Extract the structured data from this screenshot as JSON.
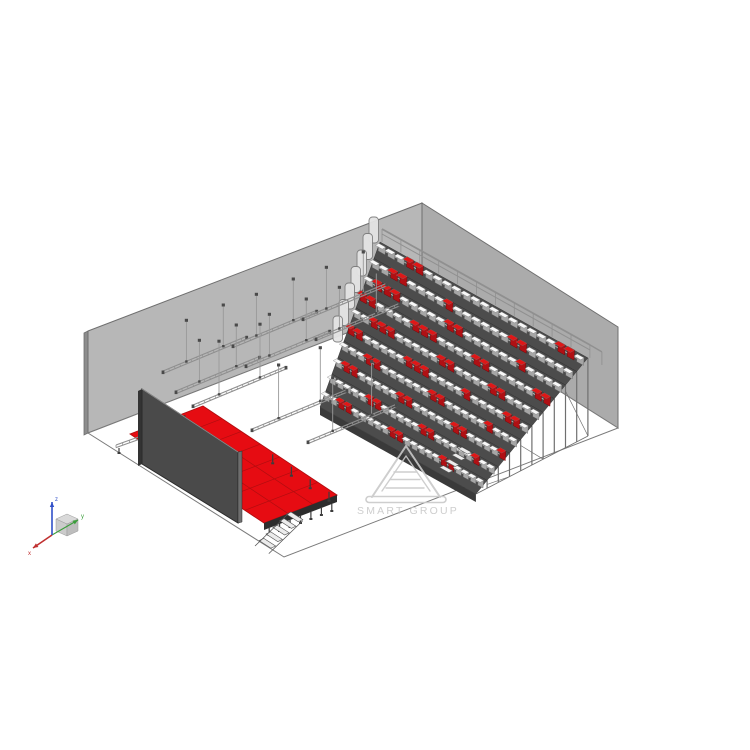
{
  "page": {
    "background": "#ffffff"
  },
  "watermark": {
    "text": "SMART GROUP",
    "color": "#c9c9c9"
  },
  "axis_triad": {
    "labels": {
      "x": "x",
      "y": "y",
      "z": "z"
    },
    "colors": {
      "x": "#c03030",
      "y": "#3a9e3a",
      "z": "#3050c8",
      "cube": "#d9d9d9"
    },
    "origin": [
      52,
      535
    ],
    "x_tip": [
      33,
      548
    ],
    "y_tip": [
      78,
      520
    ],
    "z_tip": [
      52,
      502
    ]
  },
  "scene": {
    "colors": {
      "wall_left": "#b7b7b7",
      "wall_right": "#ababab",
      "wall_edge": "#8d8d8d",
      "wall_outline": "#6f6f6f",
      "floor_fill": "#ffffff",
      "floor_outline": "#7a7a7a",
      "stage_red": "#e60c12",
      "stage_grid": "#b20d10",
      "stage_fascia": "#2d2d2d",
      "leg": "#3c3c3c",
      "screen_face": "#4a4a4a",
      "screen_edge_light": "#6e6e6e",
      "screen_outline": "#2b2b2b",
      "stand_band": "#4c4c4c",
      "stand_band_outline": "#2c2c2c",
      "stand_rail_light": "#b8b8b8",
      "stand_fascia": "#3a3a3a",
      "seat_back_gray": "#a6a6a6",
      "seat_top_white": "#f8f8f8",
      "seat_red_dark": "#b01014",
      "seat_red_bright": "#e01717",
      "railing": "#909090",
      "panel_fill": "#e4e4e4",
      "panel_stroke": "#7c7c7c",
      "truss_line": "#8f8f8f",
      "truss_conn": "#4a4a4a",
      "post": "#6f6f6f",
      "stair_fill": "#ececec",
      "stair_stroke": "#555555"
    },
    "room": {
      "left_wall_edge": [
        [
          84,
          333
        ],
        [
          88,
          331
        ],
        [
          88,
          433
        ],
        [
          84,
          435
        ]
      ],
      "left_wall": [
        [
          88,
          331
        ],
        [
          422,
          203
        ],
        [
          422,
          304
        ],
        [
          88,
          433
        ]
      ],
      "right_wall": [
        [
          422,
          203
        ],
        [
          618,
          327
        ],
        [
          618,
          428
        ],
        [
          422,
          304
        ]
      ],
      "floor": [
        [
          88,
          433
        ],
        [
          422,
          304
        ],
        [
          618,
          428
        ],
        [
          284,
          557
        ]
      ]
    },
    "stage": {
      "deck": [
        [
          130,
          434
        ],
        [
          203,
          406
        ],
        [
          337,
          495
        ],
        [
          264,
          523
        ]
      ],
      "grid_b_divs": 7,
      "grid_a_divs": 3,
      "fascia_depth": 7,
      "legs_front": 7,
      "legs_right": 4,
      "legs_back": 3,
      "stairs": {
        "x": 291,
        "y": 512,
        "steps": 5,
        "step_dx": -6.8,
        "step_dy": 6.6,
        "tread_dx": 11.8,
        "tread_dy": 7.6
      }
    },
    "screen": {
      "face": [
        [
          142,
          389
        ],
        [
          238,
          452
        ],
        [
          238,
          523
        ],
        [
          142,
          464
        ]
      ],
      "edge_right": [
        [
          238,
          452
        ],
        [
          242,
          451
        ],
        [
          242,
          522
        ],
        [
          238,
          523
        ]
      ],
      "edge_left": [
        [
          138,
          391
        ],
        [
          142,
          389
        ],
        [
          142,
          464
        ],
        [
          138,
          466
        ]
      ]
    },
    "floor_truss": {
      "x1": 116,
      "y1": 445,
      "x2": 158,
      "y2": 430
    },
    "grandstand": {
      "origin": [
        380,
        242
      ],
      "row_dx": -6.0,
      "row_dy": 16.5,
      "seat_u": [
        9.45,
        5.27
      ],
      "shrink": 0.025,
      "rows": 10,
      "cols": 22,
      "ground_back": [
        588,
        436
      ],
      "ground_front": [
        476,
        494
      ],
      "panels_rows": 7,
      "front_stair": {
        "x": 462,
        "y": 447,
        "steps": 4
      },
      "seat_map": [
        "WWWRRWWWWWWWWWWWWWWRRW",
        "WWRRWWWWRWWWWWWRRWWWWW",
        "WRRRWWWWWRRWWWWWWRWWWW",
        "RRWWWWRRRWWWWRRWWWWWRR",
        "WWRRRWWWWWRRWWWWRRWWWW",
        "RRWWWWWRRRWWWWRWWWWRRW",
        "WWWRRWWWWWWRRWWWWWRWWW",
        "WRRWWWWWRRWWWWWRRWWWWR",
        "WWWWWRRWWWWWRRWWWWWRWW",
        "WWRRWWWWWRRWWWWWRRWWWW"
      ]
    },
    "trusses": [
      {
        "x": 163,
        "y": 371,
        "len": 90,
        "rod": 40
      },
      {
        "x": 233,
        "y": 345,
        "len": 90,
        "rod": 40
      },
      {
        "x": 303,
        "y": 318,
        "len": 90,
        "rod": 40
      },
      {
        "x": 176,
        "y": 391,
        "len": 90,
        "rod": 40
      },
      {
        "x": 246,
        "y": 365,
        "len": 90,
        "rod": 40
      },
      {
        "x": 316,
        "y": 338,
        "len": 90,
        "rod": 40
      },
      {
        "x": 193,
        "y": 405,
        "len": 100,
        "rod": 52
      },
      {
        "x": 252,
        "y": 429,
        "len": 102,
        "rod": 52
      },
      {
        "x": 308,
        "y": 441,
        "len": 95,
        "rod": 52
      }
    ]
  }
}
